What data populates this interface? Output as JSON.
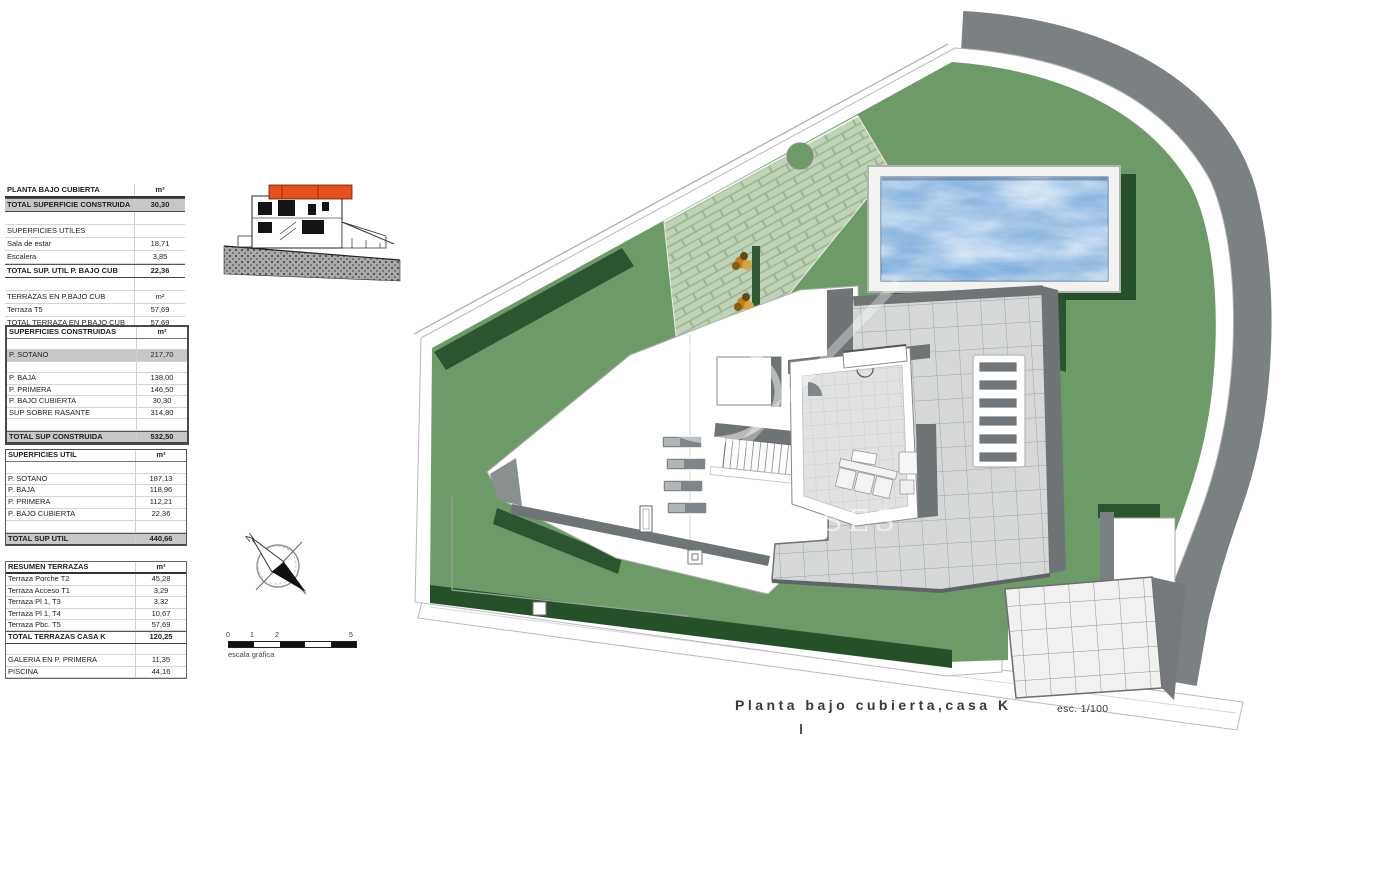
{
  "plan_title": {
    "text": "Planta bajo cubierta,casa K",
    "scale": "esc. 1/100"
  },
  "tables": {
    "planta_bajo_cubierta": {
      "rows": [
        [
          "PLANTA BAJO CUBIERTA",
          "m²",
          "hdr"
        ],
        [
          "TOTAL SUPERFICIE CONSTRUIDA",
          "30,30",
          "totalgray"
        ],
        [
          "",
          "",
          "plain"
        ],
        [
          "SUPERFICIES UTILES",
          "",
          "plain"
        ],
        [
          "Sala de estar",
          "18,71",
          "plain"
        ],
        [
          "Escalera",
          "3,85",
          "plain"
        ],
        [
          "TOTAL SUP. UTIL P. BAJO CUB",
          "22,36",
          "total"
        ],
        [
          "",
          "",
          "plain"
        ],
        [
          "TERRAZAS EN P.BAJO CUB",
          "m²",
          "plain"
        ],
        [
          "Terraza T5",
          "57,69",
          "plain"
        ],
        [
          "TOTAL TERRAZA EN P.BAJO CUB",
          "57,69",
          "plainline"
        ]
      ]
    },
    "superficies_construidas": {
      "rows": [
        [
          "SUPERFICIES CONSTRUIDAS",
          "m²",
          "hdr2"
        ],
        [
          "",
          "",
          "plain"
        ],
        [
          "P. SOTANO",
          "217,70",
          "gray"
        ],
        [
          "",
          "",
          "plain"
        ],
        [
          "P. BAJA",
          "138,00",
          "plain"
        ],
        [
          "P. PRIMERA",
          "146,50",
          "plain"
        ],
        [
          "P. BAJO CUBIERTA",
          "30,30",
          "plain"
        ],
        [
          "SUP SOBRE RASANTE",
          "314,80",
          "plain"
        ],
        [
          "",
          "",
          "plain"
        ],
        [
          "TOTAL SUP CONSTRUIDA",
          "532,50",
          "totalgray"
        ]
      ]
    },
    "superficies_util": {
      "rows": [
        [
          "SUPERFICIES UTIL",
          "m²",
          "hdr2"
        ],
        [
          "",
          "",
          "plain"
        ],
        [
          "P. SOTANO",
          "187,13",
          "plain"
        ],
        [
          "P. BAJA",
          "118,96",
          "plain"
        ],
        [
          "P. PRIMERA",
          "112,21",
          "plain"
        ],
        [
          "P. BAJO CUBIERTA",
          "22,36",
          "plain"
        ],
        [
          "",
          "",
          "plain"
        ],
        [
          "TOTAL SUP UTIL",
          "440,66",
          "totalgray"
        ]
      ]
    },
    "resumen_terrazas": {
      "rows": [
        [
          "RESUMEN TERRAZAS",
          "m²",
          "hdr"
        ],
        [
          "Terraza Porche T2",
          "45,28",
          "plain"
        ],
        [
          "Terraza Acceso T1",
          "3,29",
          "plain"
        ],
        [
          "Terraza Pl 1, T3",
          "3,32",
          "plain"
        ],
        [
          "Terraza Pl 1, T4",
          "10,67",
          "plain"
        ],
        [
          "Terraza Pbc. T5",
          "57,69",
          "plain"
        ],
        [
          "TOTAL TERRAZAS CASA K",
          "120,25",
          "total"
        ],
        [
          "",
          "",
          "plain"
        ],
        [
          "GALERIA EN P. PRIMERA",
          "11,35",
          "plain"
        ],
        [
          "PISCINA",
          "44,16",
          "plain"
        ]
      ]
    }
  },
  "compass": {
    "north_label": "N"
  },
  "scalebar": {
    "ticks": [
      "0",
      "1",
      "2",
      "5"
    ],
    "caption": "escala gráfica"
  },
  "watermark": {
    "text": "SES"
  },
  "colors": {
    "lawn": "#6d9b68",
    "lawn_shadow": "#24512a",
    "boundary_band": "#7b8083",
    "wall_gray": "#6f7476",
    "terrace_tile": "#d6d8d7",
    "patio_tile": "#f1f1ef",
    "pool_water": "#78abdc",
    "elevation_roof_highlight": "#e8501d",
    "brick_path": "#c0d3b7"
  }
}
